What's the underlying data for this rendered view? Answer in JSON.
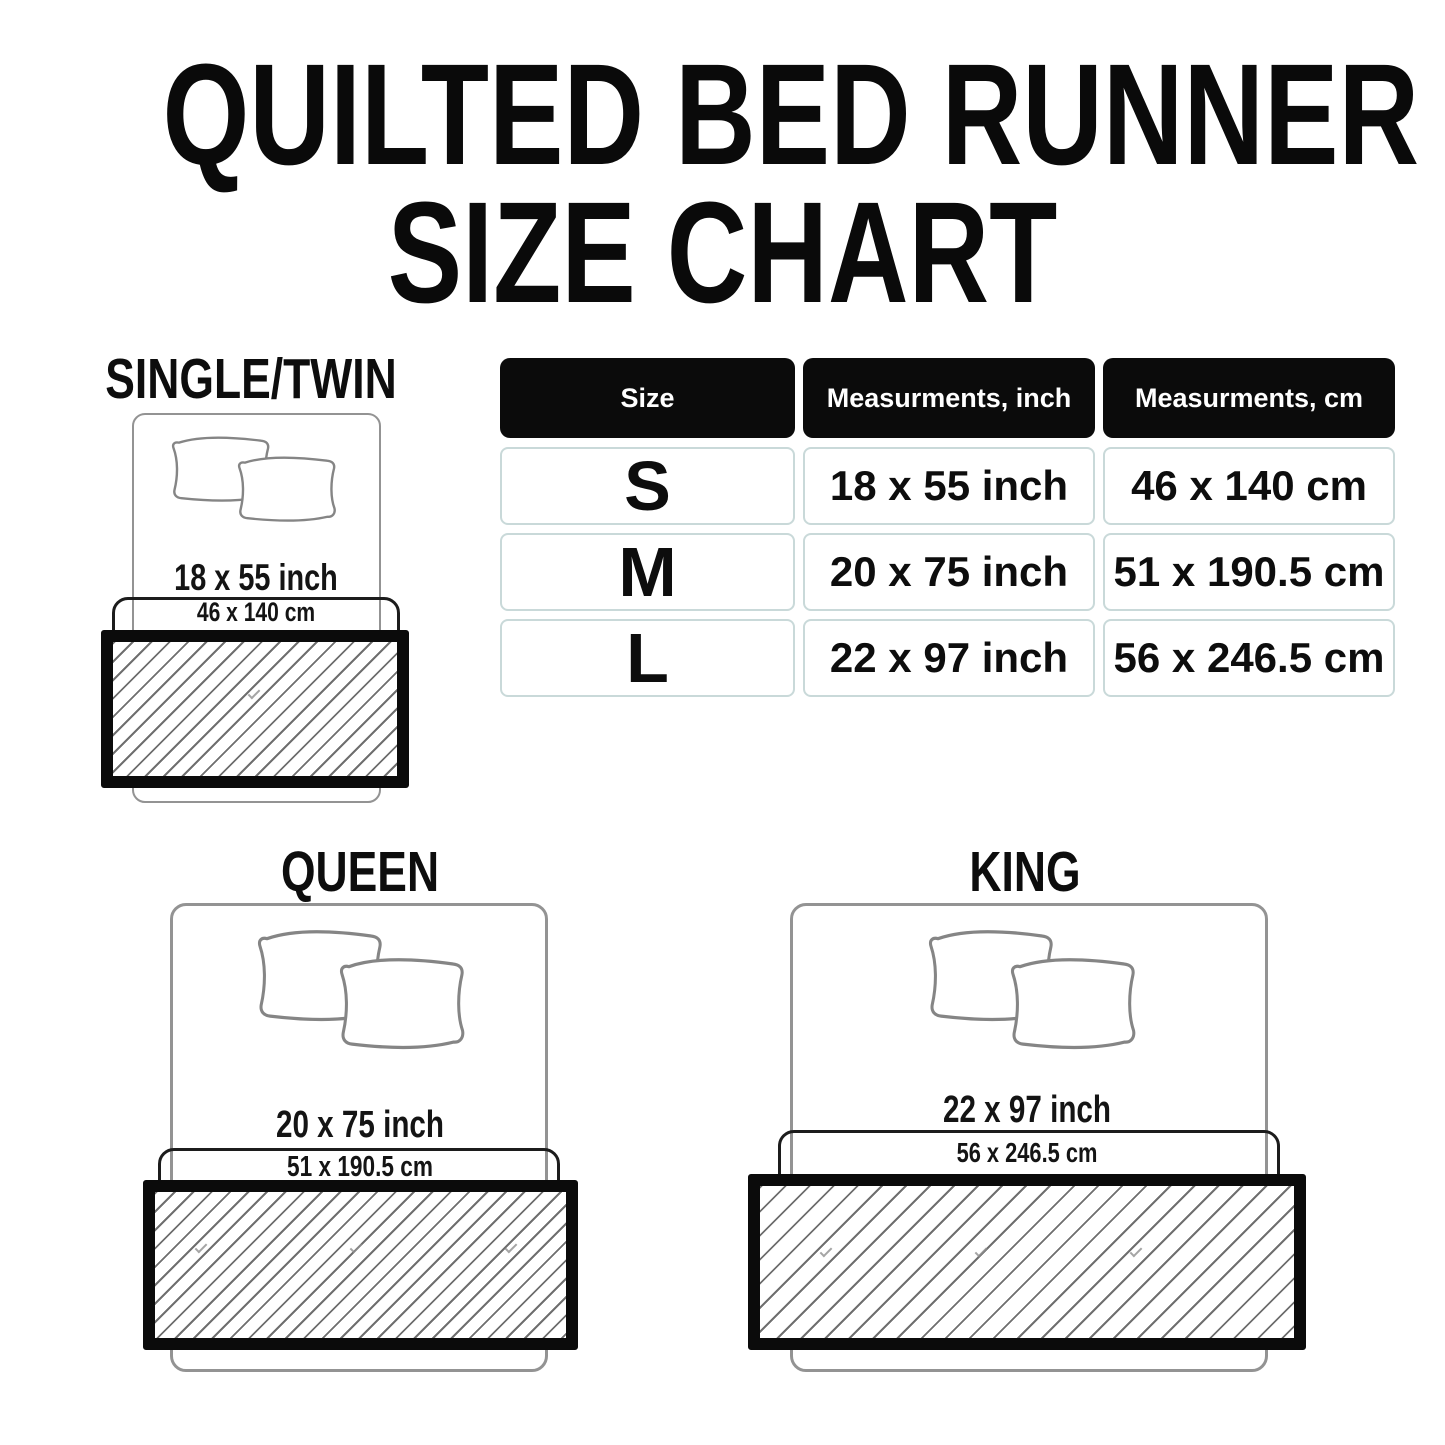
{
  "title": {
    "line1": "QUILTED BED RUNNER",
    "line2": "SIZE CHART"
  },
  "table": {
    "headers": {
      "size": "Size",
      "inch": "Measurments, inch",
      "cm": "Measurments, cm"
    },
    "rows": [
      {
        "size": "S",
        "inch": "18 x 55 inch",
        "cm": "46 x 140 cm"
      },
      {
        "size": "M",
        "inch": "20 x 75 inch",
        "cm": "51 x 190.5 cm"
      },
      {
        "size": "L",
        "inch": "22 x 97 inch",
        "cm": "56 x 246.5 cm"
      }
    ]
  },
  "sections": {
    "single_twin": {
      "label": "SINGLE/TWIN",
      "inch": "18 x 55 inch",
      "cm": "46 x 140 cm"
    },
    "queen": {
      "label": "QUEEN",
      "inch": "20 x 75 inch",
      "cm": "51 x 190.5 cm"
    },
    "king": {
      "label": "KING",
      "inch": "22 x 97 inch",
      "cm": "56 x 246.5 cm"
    }
  },
  "colors": {
    "background": "#ffffff",
    "text": "#0d0d0d",
    "table_header_bg": "#0b0b0b",
    "table_header_text": "#ffffff",
    "table_cell_border": "#c9d9d9",
    "bed_outline_gray": "#939393",
    "bracket_border": "#1c1c1c",
    "runner_border": "#0b0b0b",
    "hatch_line": "#6f6f6f"
  },
  "chart_data": {
    "type": "table",
    "title": "QUILTED BED RUNNER SIZE CHART",
    "columns": [
      "Size",
      "Measurments, inch",
      "Measurments, cm"
    ],
    "rows": [
      [
        "S",
        "18 x 55 inch",
        "46 x 140 cm"
      ],
      [
        "M",
        "20 x 75 inch",
        "51 x 190.5 cm"
      ],
      [
        "L",
        "22 x 97 inch",
        "56 x 246.5 cm"
      ]
    ]
  }
}
